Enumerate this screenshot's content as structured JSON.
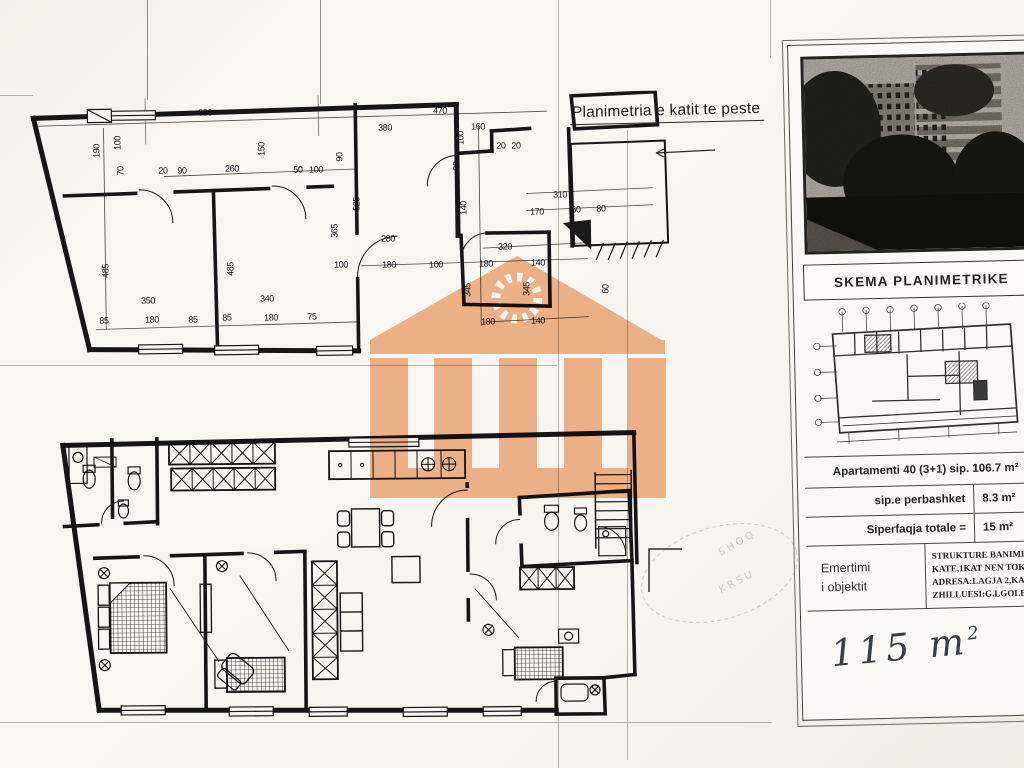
{
  "sheet": {
    "title": "Planimetria e katit te peste"
  },
  "panel": {
    "header": "SKEMA PLANIMETRIKE",
    "info_rows": [
      {
        "label": "Apartamenti 40 (3+1) sip. 106.7 m²",
        "value": ""
      },
      {
        "label": "sip.e perbashket",
        "value": "8.3 m²"
      },
      {
        "label": "Siperfaqja totale =",
        "value": "15 m²"
      }
    ],
    "emertimi": {
      "line1": "Emertimi",
      "line2": "i objektit",
      "details": [
        "STRUKTURE BANIMI 4-8",
        "KATE,1KAT NEN TOKE",
        "ADRESA:LAGJA 2,KAVAJ",
        "ZHILLUESI:G.LGOLEM ALB"
      ]
    },
    "handwritten": {
      "value": "115 m",
      "exponent": "2"
    }
  },
  "watermark": {
    "color": "#f2ad80"
  },
  "upper_plan": {
    "dimensions": [
      {
        "t": "320",
        "x": 205,
        "y": 113
      },
      {
        "t": "470",
        "x": 440,
        "y": 111
      },
      {
        "t": "380",
        "x": 385,
        "y": 128
      },
      {
        "t": "160",
        "x": 478,
        "y": 127
      },
      {
        "t": "20",
        "x": 163,
        "y": 171
      },
      {
        "t": "90",
        "x": 182,
        "y": 171
      },
      {
        "t": "260",
        "x": 232,
        "y": 169
      },
      {
        "t": "50",
        "x": 298,
        "y": 170
      },
      {
        "t": "100",
        "x": 316,
        "y": 170
      },
      {
        "t": "280",
        "x": 388,
        "y": 239
      },
      {
        "t": "100",
        "x": 341,
        "y": 265
      },
      {
        "t": "180",
        "x": 389,
        "y": 265
      },
      {
        "t": "100",
        "x": 436,
        "y": 265
      },
      {
        "t": "180",
        "x": 486,
        "y": 264
      },
      {
        "t": "140",
        "x": 538,
        "y": 263
      },
      {
        "t": "350",
        "x": 148,
        "y": 301
      },
      {
        "t": "340",
        "x": 267,
        "y": 299
      },
      {
        "t": "85",
        "x": 104,
        "y": 321
      },
      {
        "t": "180",
        "x": 152,
        "y": 320
      },
      {
        "t": "85",
        "x": 193,
        "y": 320
      },
      {
        "t": "85",
        "x": 227,
        "y": 318
      },
      {
        "t": "180",
        "x": 271,
        "y": 318
      },
      {
        "t": "75",
        "x": 312,
        "y": 317
      },
      {
        "t": "20",
        "x": 501,
        "y": 146
      },
      {
        "t": "20",
        "x": 516,
        "y": 146
      },
      {
        "t": "310",
        "x": 560,
        "y": 195
      },
      {
        "t": "170",
        "x": 537,
        "y": 212
      },
      {
        "t": "60",
        "x": 576,
        "y": 210
      },
      {
        "t": "80",
        "x": 601,
        "y": 209
      },
      {
        "t": "320",
        "x": 505,
        "y": 247
      },
      {
        "t": "180",
        "x": 488,
        "y": 322
      },
      {
        "t": "140",
        "x": 538,
        "y": 321
      },
      {
        "t": "190",
        "x": 97,
        "y": 151,
        "v": true
      },
      {
        "t": "100",
        "x": 118,
        "y": 143,
        "v": true
      },
      {
        "t": "70",
        "x": 121,
        "y": 171,
        "v": true
      },
      {
        "t": "150",
        "x": 262,
        "y": 149,
        "v": true
      },
      {
        "t": "90",
        "x": 340,
        "y": 157,
        "v": true
      },
      {
        "t": "525",
        "x": 357,
        "y": 204,
        "v": true
      },
      {
        "t": "365",
        "x": 335,
        "y": 231,
        "v": true
      },
      {
        "t": "485",
        "x": 106,
        "y": 271,
        "v": true
      },
      {
        "t": "485",
        "x": 231,
        "y": 269,
        "v": true
      },
      {
        "t": "100",
        "x": 461,
        "y": 138,
        "v": true
      },
      {
        "t": "90",
        "x": 457,
        "y": 166,
        "v": true
      },
      {
        "t": "140",
        "x": 464,
        "y": 208,
        "v": true
      },
      {
        "t": "345",
        "x": 468,
        "y": 290,
        "v": true
      },
      {
        "t": "345",
        "x": 527,
        "y": 289,
        "v": true
      },
      {
        "t": "60",
        "x": 606,
        "y": 289,
        "v": true
      }
    ]
  }
}
